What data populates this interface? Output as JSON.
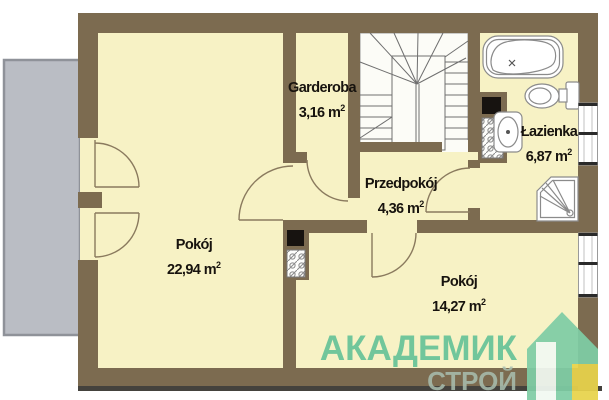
{
  "rooms": [
    {
      "name": "Pokój",
      "area": "22,94"
    },
    {
      "name": "Garderoba",
      "area": "3,16"
    },
    {
      "name": "Przedpokój",
      "area": "4,36"
    },
    {
      "name": "Łazienka",
      "area": "6,87"
    },
    {
      "name": "Pokój",
      "area": "14,27"
    }
  ],
  "area_unit": {
    "symbol": "m",
    "superscript": "2"
  },
  "watermark": {
    "line1": "АКАДЕМИК",
    "line2": "СТРОЙ",
    "color_primary": "#5fc096",
    "color_secondary": "#a9bfb0",
    "logo_green": "#7fcda5",
    "logo_yellow": "#e8d34b"
  },
  "palette": {
    "wall": "#7c6b50",
    "floor": "#f7f2c5",
    "balcony": "#babdc4",
    "fixture_line": "#8b8b8b",
    "ground_shadow": "#44423d"
  },
  "fixtures": [
    "balcony",
    "balcony-door",
    "balcony-door",
    "stairs",
    "chimney-flue",
    "chimney-flue",
    "bathtub",
    "toilet",
    "washbasin",
    "shower",
    "window",
    "window"
  ]
}
